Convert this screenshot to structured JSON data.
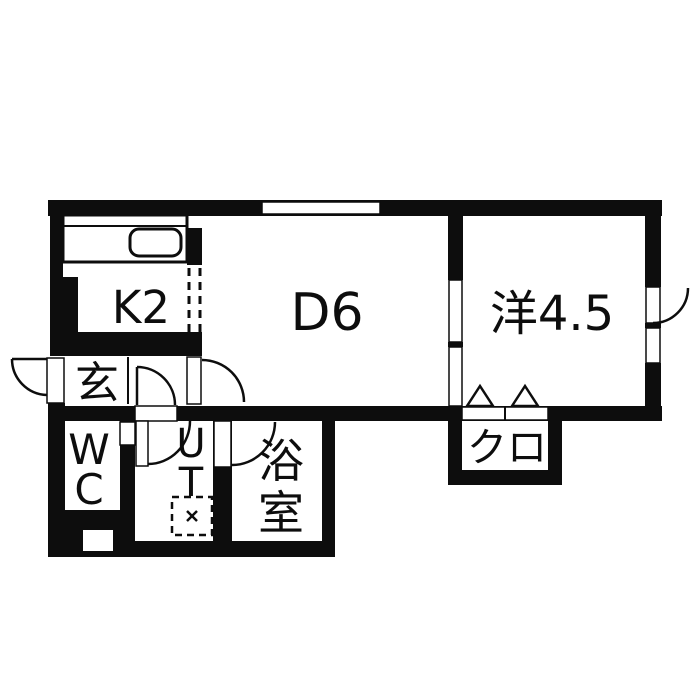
{
  "floor_plan": {
    "wall_color": "#0d0d0d",
    "floor_color": "#ffffff",
    "labels": {
      "kitchen": "K2",
      "dining": "D6",
      "western_room": "洋4.5",
      "entrance": "玄",
      "toilet_top": "W",
      "toilet_bottom": "C",
      "utility_top": "U",
      "utility_bottom": "T",
      "bathroom_top": "浴",
      "bathroom_bottom": "室",
      "closet": "クロ"
    }
  }
}
